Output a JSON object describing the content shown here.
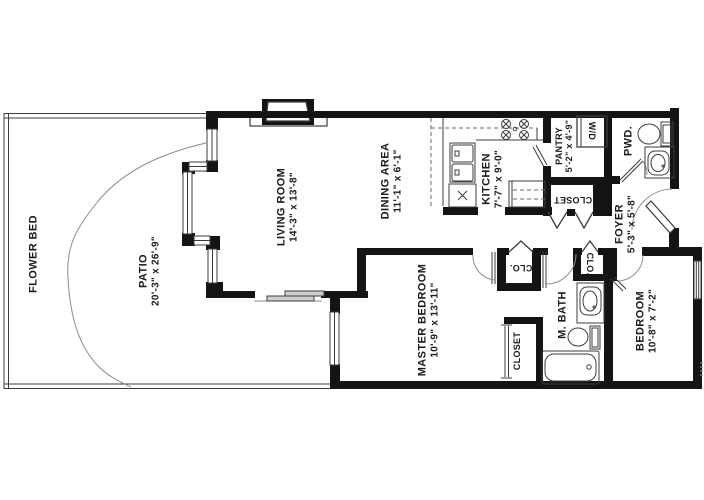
{
  "title": "Apartment unit floor plan",
  "rooms": {
    "flower_bed": {
      "name": "FLOWER BED"
    },
    "patio": {
      "name": "PATIO",
      "dims": "20'-3\" x 26'-9\""
    },
    "living_room": {
      "name": "LIVING ROOM",
      "dims": "14'-3\" x 13'-8\""
    },
    "dining_area": {
      "name": "DINING AREA",
      "dims": "11'-1\" x 6'-1\""
    },
    "kitchen": {
      "name": "KITCHEN",
      "dims": "7'-7\" x 9'-0\""
    },
    "pantry": {
      "name": "PANTRY",
      "dims": "5'-2\" x 4'-9\""
    },
    "laundry": {
      "name": "W/D"
    },
    "powder_room": {
      "name": "PWD."
    },
    "hall_closet": {
      "name": "CLOSET"
    },
    "foyer": {
      "name": "FOYER",
      "dims": "5'-3\" x 5'-8\""
    },
    "master_bedroom": {
      "name": "MASTER BEDROOM",
      "dims": "10'-9\" x 13'-11\""
    },
    "closet_left": {
      "name": "CLO."
    },
    "closet_right": {
      "name": "CLO."
    },
    "master_bath": {
      "name": "M. BATH"
    },
    "master_closet": {
      "name": "CLOSET"
    },
    "bedroom": {
      "name": "BEDROOM",
      "dims": "10'-8\" x 7'-2\""
    }
  },
  "colors": {
    "wall": "#141414",
    "line": "#3c3c3c",
    "soft_line": "#8a8a8a",
    "glass_panel": "#cfcfcf",
    "background": "#ffffff"
  }
}
